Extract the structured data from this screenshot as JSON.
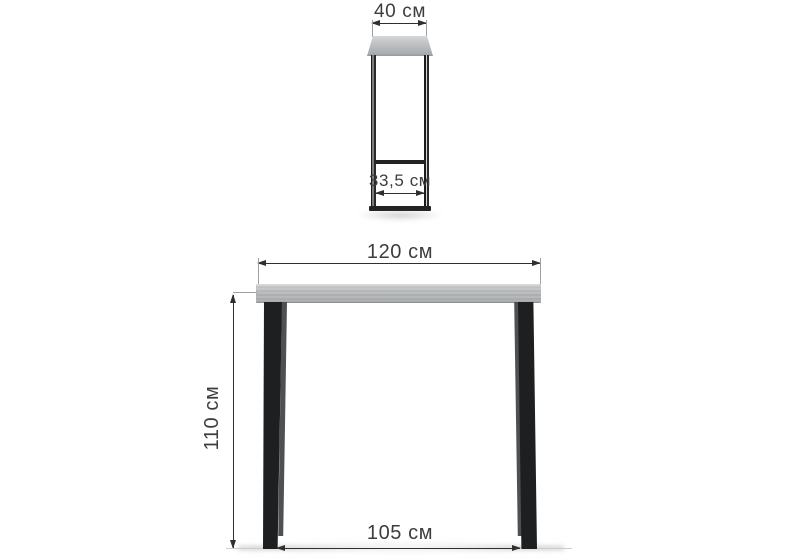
{
  "side_view": {
    "top_width_label": "40 см",
    "leg_depth_label": "33,5 см"
  },
  "front_view": {
    "width_label": "120 см",
    "height_label": "110 см",
    "base_width_label": "105 см"
  },
  "colors": {
    "background": "#ffffff",
    "dimension_lines": "#2f2f2f",
    "extension_lines": "#a0a0a0",
    "labels": "#3d3d3d",
    "tabletop": "#b4b6b8",
    "tabletop_highlight": "#d2d4d5",
    "tabletop_edge": "#8f9294",
    "legs": "#1e1f21",
    "legs_highlight": "#4e5053"
  }
}
